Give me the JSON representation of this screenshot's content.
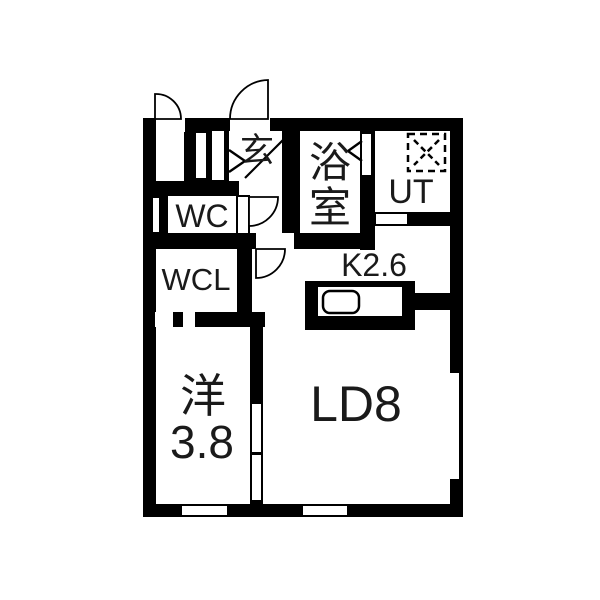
{
  "floorplan": {
    "type": "japanese-apartment-1ldk",
    "wall_color": "#000000",
    "floor_color": "#ffffff",
    "labels": {
      "genkan": "玄",
      "bathroom_char1": "浴",
      "bathroom_char2": "室",
      "utility": "UT",
      "toilet": "WC",
      "closet": "WCL",
      "kitchen": "K2.6",
      "western_room_char": "洋",
      "western_room_size": "3.8",
      "living_dining": "LD8"
    },
    "fixtures": {
      "washer_box": "dashed-square-with-x",
      "sink": "rounded-rectangle"
    }
  }
}
